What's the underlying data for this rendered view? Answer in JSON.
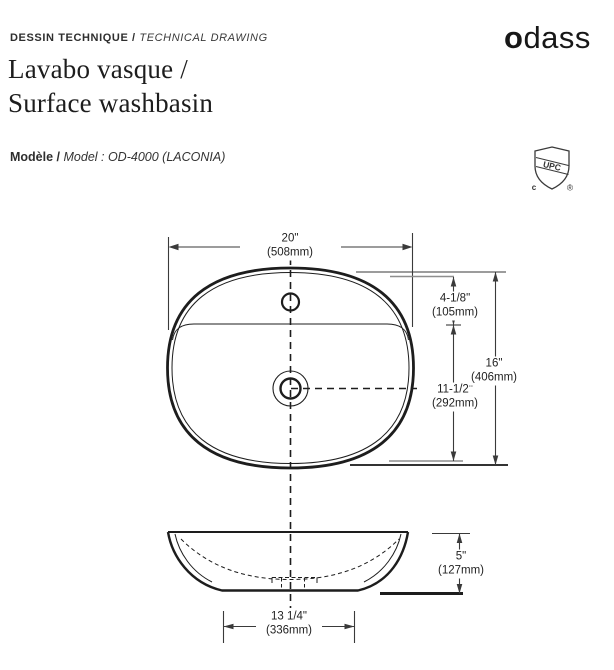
{
  "header": {
    "eyebrow_fr": "DESSIN TECHNIQUE /",
    "eyebrow_en": "TECHNICAL DRAWING",
    "title_line1": "Lavabo vasque /",
    "title_line2": "Surface washbasin",
    "logo_first": "o",
    "logo_rest": "dass",
    "model_label": "Modèle /",
    "model_value": "Model : OD-4000 (LACONIA)"
  },
  "certification": {
    "band_text": "UPC",
    "left_text": "c",
    "right_text": "®"
  },
  "drawing": {
    "line_color": "#2b2b2b",
    "dims": {
      "overall_width": {
        "in": "20\"",
        "mm": "(508mm)"
      },
      "faucet_to_edge": {
        "in": "4-1/8\"",
        "mm": "(105mm)"
      },
      "drain_to_deck": {
        "in": "11-1/2\"",
        "mm": "(292mm)"
      },
      "overall_depth": {
        "in": "16\"",
        "mm": "(406mm)"
      },
      "height": {
        "in": "5\"",
        "mm": "(127mm)"
      },
      "base_width": {
        "in": "13 1/4\"",
        "mm": "(336mm)"
      }
    }
  }
}
